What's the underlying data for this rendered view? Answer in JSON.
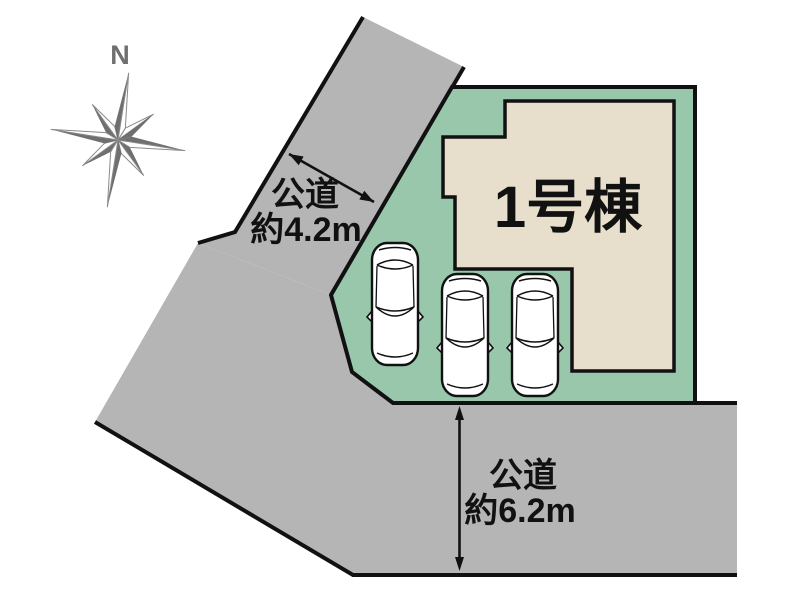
{
  "diagram": {
    "type": "residential-plot-layout",
    "building": {
      "label": "1号棟"
    },
    "roads": {
      "west": {
        "name": "公道",
        "width_note": "約4.2m"
      },
      "south": {
        "name": "公道",
        "width_note": "約6.2m"
      }
    },
    "compass": {
      "north_label": "N"
    },
    "parking": {
      "car_count": 3
    }
  },
  "colors": {
    "background": "#ffffff",
    "road": "#b5b5b5",
    "lot_green": "#98c7ac",
    "building_fill": "#e7dfcc",
    "outline": "#111111",
    "compass_gray": "#6f6f6f",
    "car_fill": "#ffffff"
  }
}
